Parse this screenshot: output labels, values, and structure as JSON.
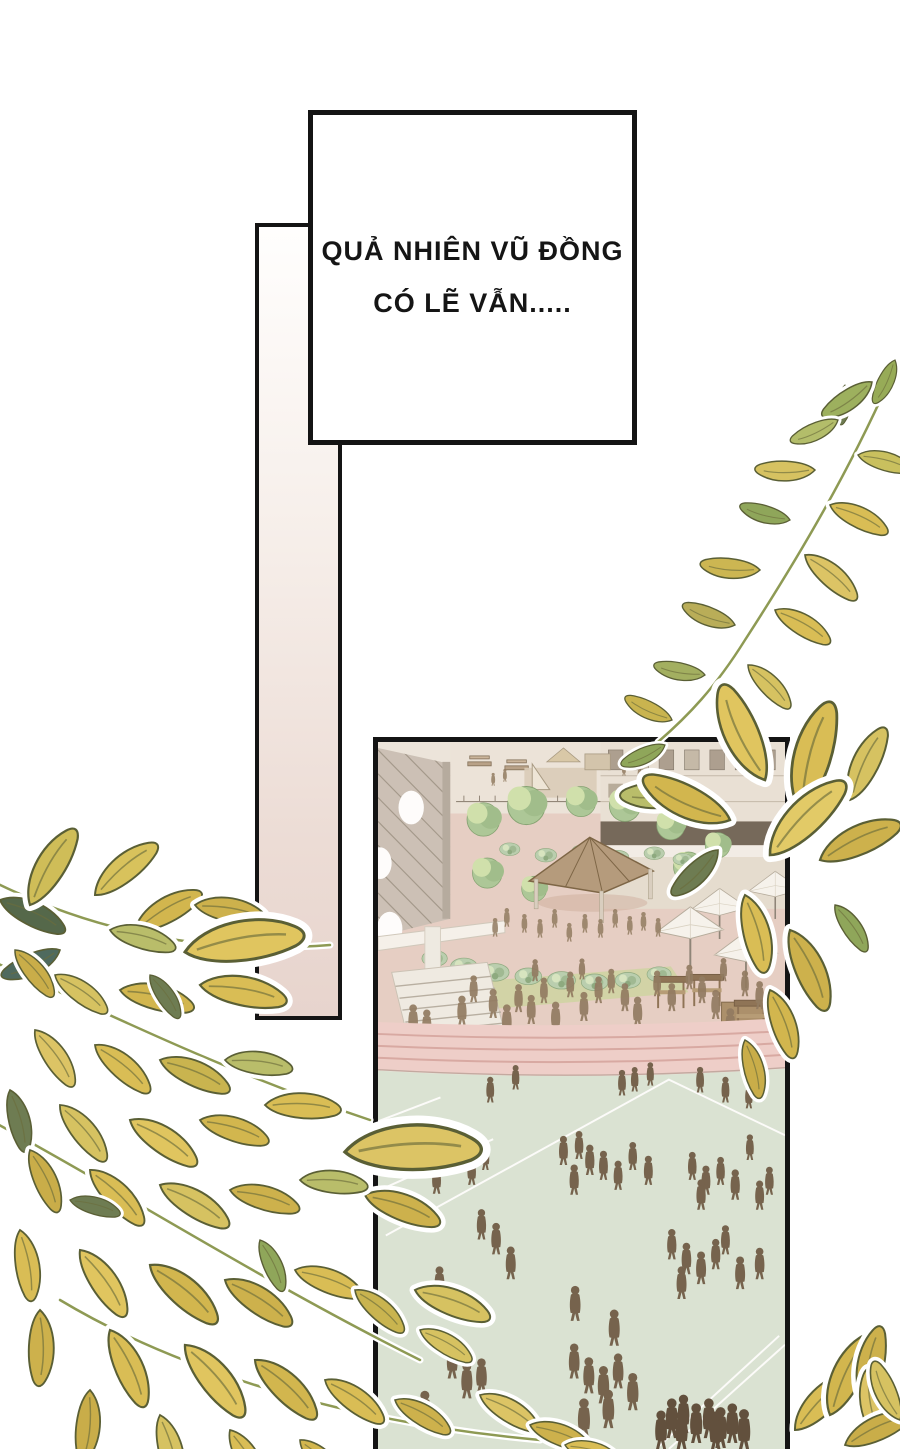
{
  "speech_box": {
    "line1": "QUẢ NHIÊN VŨ ĐỒNG",
    "line2": "CÓ LẼ VẪN....."
  },
  "colors": {
    "panel_border": "#141414",
    "bar_gradient_bottom": "#e7d4cd",
    "leaf_yellow": "#d9bd55",
    "leaf_olive": "#6e7c52",
    "track_pink": "#eecfc9",
    "track_line": "#d7a7a1",
    "field_green": "#d9e4d4",
    "courtyard_ground": "#e6cfc4",
    "silhouette_brown": "#6f5d47",
    "tree_green": "#a9c795",
    "gazebo_roof": "#b29879"
  }
}
